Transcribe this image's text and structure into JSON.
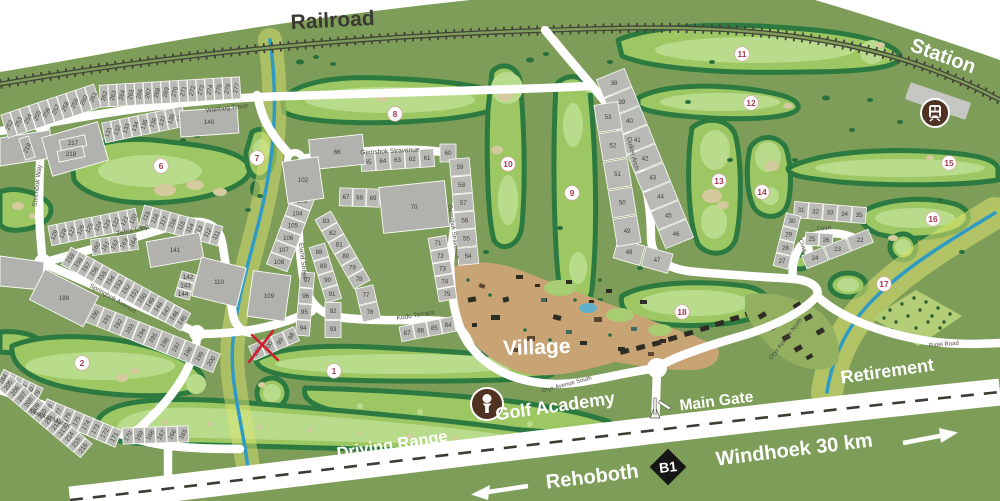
{
  "map": {
    "labels": {
      "railroad": "Railroad",
      "station": "Station",
      "village": "Village",
      "golf_academy": "Golf Academy",
      "driving_range": "Driving Range",
      "main_gate": "Main Gate",
      "retirement": "Retirement",
      "rehoboth": "Rehoboth",
      "windhoek": "Windhoek 30 km",
      "b1": "B1"
    },
    "annotations": {
      "red_x_marked_plot": "100"
    },
    "colors": {
      "land": "#7d9d58",
      "fairway": "#9cc763",
      "fairway_light": "#b8dc8b",
      "rough_rim": "#2c7a40",
      "bunker": "#d5c99e",
      "road": "#ffffff",
      "river": "#2f9bc4",
      "river_glow": "#dce26f",
      "plot_gray": "#b9b9b6",
      "icon_brown": "#4f3222",
      "hole_number": "#a63d53",
      "rail": "#43433a",
      "red_x": "#cf2030"
    },
    "streets": [
      {
        "name": "Warthog Trace",
        "x": 227,
        "y": 110,
        "rot": -7,
        "size": 6.5
      },
      {
        "name": "Steenbok Way",
        "x": 39,
        "y": 186,
        "rot": -83,
        "size": 6.5
      },
      {
        "name": "Zebra Loop",
        "x": 133,
        "y": 232,
        "rot": -13,
        "size": 6.5
      },
      {
        "name": "Springbok Avenue",
        "x": 112,
        "y": 300,
        "rot": 30,
        "size": 6.5
      },
      {
        "name": "Meerkat Manor",
        "x": 49,
        "y": 420,
        "rot": 21,
        "size": 6.5
      },
      {
        "name": "Gemsbok Stravenue",
        "x": 390,
        "y": 153,
        "rot": -3,
        "size": 6.5
      },
      {
        "name": "Gemsbok Stravenue",
        "x": 452,
        "y": 232,
        "rot": 82,
        "size": 6
      },
      {
        "name": "Eland Street",
        "x": 301,
        "y": 261,
        "rot": 83,
        "size": 6.5
      },
      {
        "name": "Kudu Terrace",
        "x": 416,
        "y": 317,
        "rot": -9,
        "size": 6.5
      },
      {
        "name": "Duiker Arch",
        "x": 631,
        "y": 154,
        "rot": 76,
        "size": 6.5
      },
      {
        "name": "Civet",
        "x": 801,
        "y": 246,
        "rot": 70,
        "size": 6
      },
      {
        "name": "Court",
        "x": 824,
        "y": 230,
        "rot": -6,
        "size": 6
      },
      {
        "name": "Oryx Avenue South",
        "x": 567,
        "y": 386,
        "rot": -15,
        "size": 6
      },
      {
        "name": "Oryx Avenue North",
        "x": 787,
        "y": 340,
        "rot": -52,
        "size": 6
      },
      {
        "name": "Ratel Road",
        "x": 944,
        "y": 346,
        "rot": -5,
        "size": 6
      }
    ],
    "holes": [
      {
        "n": "1",
        "x": 334,
        "y": 371
      },
      {
        "n": "2",
        "x": 82,
        "y": 363
      },
      {
        "n": "6",
        "x": 161,
        "y": 166
      },
      {
        "n": "7",
        "x": 257,
        "y": 158
      },
      {
        "n": "8",
        "x": 395,
        "y": 114
      },
      {
        "n": "9",
        "x": 572,
        "y": 193
      },
      {
        "n": "10",
        "x": 508,
        "y": 164
      },
      {
        "n": "11",
        "x": 742,
        "y": 54
      },
      {
        "n": "12",
        "x": 751,
        "y": 103
      },
      {
        "n": "13",
        "x": 719,
        "y": 181
      },
      {
        "n": "14",
        "x": 762,
        "y": 192
      },
      {
        "n": "15",
        "x": 949,
        "y": 163
      },
      {
        "n": "16",
        "x": 933,
        "y": 219
      },
      {
        "n": "17",
        "x": 884,
        "y": 284
      },
      {
        "n": "18",
        "x": 682,
        "y": 312
      }
    ],
    "plots": {
      "strips": [
        {
          "f": [
            9,
            125
          ],
          "t": [
            93,
            97
          ],
          "d": 24,
          "tr": -65,
          "nums": [
            "252",
            "253",
            "254",
            "255",
            "256",
            "257",
            "258",
            "259",
            "260",
            "261"
          ]
        },
        {
          "f": [
            104,
            96
          ],
          "t": [
            236,
            88
          ],
          "d": 22,
          "tr": -75,
          "nums": [
            "262",
            "263",
            "264",
            "265",
            "266",
            "267",
            "268",
            "269",
            "270",
            "271",
            "272",
            "273",
            "274",
            "275",
            "276",
            "277"
          ]
        },
        {
          "f": [
            108,
            132
          ],
          "t": [
            180,
            117
          ],
          "d": 20,
          "tr": -70,
          "nums": [
            "131",
            "132",
            "133",
            "134",
            "135",
            "136",
            "137",
            "138",
            "139"
          ]
        },
        {
          "f": [
            146,
            216
          ],
          "t": [
            216,
            235
          ],
          "d": 20,
          "tr": -60,
          "nums": [
            "119",
            "118",
            "117",
            "116",
            "115",
            "114",
            "113",
            "112",
            "111"
          ]
        },
        {
          "f": [
            54,
            235
          ],
          "t": [
            133,
            219
          ],
          "d": 20,
          "tr": -65,
          "nums": [
            "129",
            "128",
            "127",
            "126",
            "125",
            "124",
            "123",
            "122",
            "121",
            "120"
          ]
        },
        {
          "f": [
            96,
            247
          ],
          "t": [
            133,
            242
          ],
          "d": 16,
          "tr": -60,
          "nums": [
            "160",
            "161",
            "162",
            "163",
            "164"
          ]
        },
        {
          "f": [
            70,
            258
          ],
          "t": [
            182,
            320
          ],
          "d": 20,
          "tr": -50,
          "nums": [
            "159",
            "158",
            "157",
            "156",
            "155",
            "154",
            "153",
            "152",
            "151",
            "150",
            "149",
            "148",
            "147",
            "146",
            "145"
          ]
        },
        {
          "f": [
            83,
            310
          ],
          "t": [
            211,
            361
          ],
          "d": 20,
          "tr": -55,
          "nums": [
            "189",
            "190",
            "191",
            "192",
            "193",
            "194",
            "195",
            "196",
            "197",
            "198",
            "199",
            "200"
          ]
        },
        {
          "f": [
            3,
            379
          ],
          "t": [
            36,
            395
          ],
          "d": 18,
          "tr": -60,
          "nums": [
            "184",
            "183",
            "182",
            "181",
            "180",
            "179"
          ]
        },
        {
          "f": [
            48,
            409
          ],
          "t": [
            114,
            437
          ],
          "d": 18,
          "tr": -60,
          "nums": [
            "178",
            "177",
            "176",
            "175",
            "174",
            "173",
            "172",
            "171"
          ]
        },
        {
          "f": [
            128,
            436
          ],
          "t": [
            183,
            434
          ],
          "d": 16,
          "tr": -60,
          "nums": [
            "170",
            "169",
            "168",
            "167",
            "166",
            "165"
          ]
        },
        {
          "f": [
            8,
            385
          ],
          "t": [
            83,
            448
          ],
          "d": 18,
          "tr": -55,
          "nums": [
            "205",
            "206",
            "207",
            "208",
            "209",
            "210",
            "211",
            "212",
            "213",
            "214",
            "215",
            "216"
          ]
        },
        {
          "f": [
            302,
            201
          ],
          "t": [
            279,
            262
          ],
          "d": 22,
          "tr": 0,
          "nums": [
            "103",
            "104",
            "105",
            "106",
            "107",
            "108"
          ]
        },
        {
          "f": [
            368,
            162
          ],
          "t": [
            427,
            158
          ],
          "d": 18,
          "tr": 0,
          "nums": [
            "65",
            "64",
            "63",
            "62",
            "61"
          ]
        },
        {
          "f": [
            448,
            153
          ],
          "t": [
            448,
            153
          ],
          "d": 18,
          "cw": 16,
          "tr": 0,
          "nums": [
            "60"
          ]
        },
        {
          "f": [
            460,
            167
          ],
          "t": [
            468,
            256
          ],
          "d": 20,
          "tr": 0,
          "nums": [
            "59",
            "58",
            "57",
            "56",
            "55",
            "54"
          ]
        },
        {
          "f": [
            346,
            197
          ],
          "t": [
            373,
            198
          ],
          "d": 18,
          "tr": 0,
          "nums": [
            "67",
            "68",
            "69"
          ]
        },
        {
          "f": [
            438,
            243
          ],
          "t": [
            447,
            294
          ],
          "d": 18,
          "tr": 0,
          "nums": [
            "71",
            "72",
            "73",
            "74",
            "75"
          ]
        },
        {
          "f": [
            326,
            221
          ],
          "t": [
            359,
            279
          ],
          "d": 18,
          "tr": 0,
          "nums": [
            "83",
            "82",
            "81",
            "80",
            "79",
            "78"
          ]
        },
        {
          "f": [
            319,
            252
          ],
          "t": [
            332,
            294
          ],
          "d": 16,
          "tr": 0,
          "nums": [
            "88",
            "89",
            "90",
            "91"
          ]
        },
        {
          "f": [
            307,
            280
          ],
          "t": [
            303,
            328
          ],
          "d": 14,
          "tr": 0,
          "nums": [
            "97",
            "96",
            "95",
            "94"
          ]
        },
        {
          "f": [
            333,
            311
          ],
          "t": [
            333,
            329
          ],
          "d": 16,
          "tr": 0,
          "nums": [
            "92",
            "93"
          ]
        },
        {
          "f": [
            291,
            336
          ],
          "t": [
            257,
            351
          ],
          "d": 15,
          "tr": -60,
          "nums": [
            "98",
            "99",
            "100",
            "101"
          ]
        },
        {
          "f": [
            366,
            295
          ],
          "t": [
            370,
            312
          ],
          "d": 18,
          "tr": 0,
          "nums": [
            "77",
            "76"
          ]
        },
        {
          "f": [
            448,
            325
          ],
          "t": [
            407,
            333
          ],
          "d": 15,
          "tr": 0,
          "nums": [
            "84",
            "85",
            "86",
            "87"
          ]
        },
        {
          "f": [
            614,
            83
          ],
          "t": [
            676,
            234
          ],
          "d": 30,
          "tr": 0,
          "nums": [
            "38",
            "39",
            "40",
            "41",
            "42",
            "43",
            "44",
            "45",
            "46"
          ]
        },
        {
          "f": [
            657,
            260
          ],
          "t": [
            629,
            252
          ],
          "d": 20,
          "tr": 0,
          "nums": [
            "47",
            "48"
          ]
        },
        {
          "f": [
            608,
            117
          ],
          "t": [
            627,
            231
          ],
          "d": 24,
          "tr": 0,
          "nums": [
            "53",
            "52",
            "51",
            "50",
            "49"
          ]
        },
        {
          "f": [
            801,
            210
          ],
          "t": [
            859,
            215
          ],
          "d": 16,
          "tr": 0,
          "nums": [
            "31",
            "32",
            "33",
            "34",
            "35"
          ]
        },
        {
          "f": [
            792,
            221
          ],
          "t": [
            782,
            261
          ],
          "d": 15,
          "tr": 0,
          "nums": [
            "30",
            "29",
            "28",
            "27"
          ]
        },
        {
          "f": [
            812,
            239
          ],
          "t": [
            826,
            240
          ],
          "d": 13,
          "tr": 0,
          "nums": [
            "25",
            "26"
          ]
        },
        {
          "f": [
            860,
            240
          ],
          "t": [
            815,
            258
          ],
          "d": 14,
          "tr": 0,
          "nums": [
            "22",
            "23",
            "24"
          ]
        },
        {
          "f": [
            188,
            277
          ],
          "t": [
            183,
            294
          ],
          "d": 15,
          "tr": 0,
          "nums": [
            "142",
            "143",
            "144"
          ]
        }
      ],
      "blocks": [
        {
          "n": "130",
          "x": 75,
          "y": 149,
          "w": 58,
          "h": 40,
          "rot": -16
        },
        {
          "n": "140",
          "x": 209,
          "y": 122,
          "w": 58,
          "h": 26,
          "rot": -4
        },
        {
          "n": "66",
          "x": 337,
          "y": 152,
          "w": 54,
          "h": 30,
          "rot": -6
        },
        {
          "n": "102",
          "x": 303,
          "y": 180,
          "w": 36,
          "h": 42,
          "rot": -8
        },
        {
          "n": "70",
          "x": 414,
          "y": 207,
          "w": 66,
          "h": 46,
          "rot": -6
        },
        {
          "n": "141",
          "x": 175,
          "y": 250,
          "w": 54,
          "h": 26,
          "rot": -10
        },
        {
          "n": "110",
          "x": 219,
          "y": 282,
          "w": 46,
          "h": 40,
          "rot": 14
        },
        {
          "n": "188",
          "x": 64,
          "y": 298,
          "w": 60,
          "h": 34,
          "rot": 27
        },
        {
          "n": "109",
          "x": 269,
          "y": 296,
          "w": 38,
          "h": 46,
          "rot": 8
        },
        {
          "n": "217",
          "x": 73,
          "y": 143,
          "w": 26,
          "h": 11,
          "rot": -12
        },
        {
          "n": "218",
          "x": 71,
          "y": 154,
          "w": 26,
          "h": 11,
          "rot": -12
        },
        {
          "n": "219",
          "x": 27,
          "y": 148,
          "w": 10,
          "h": 22,
          "rot": -18,
          "tr": -65
        }
      ]
    }
  }
}
